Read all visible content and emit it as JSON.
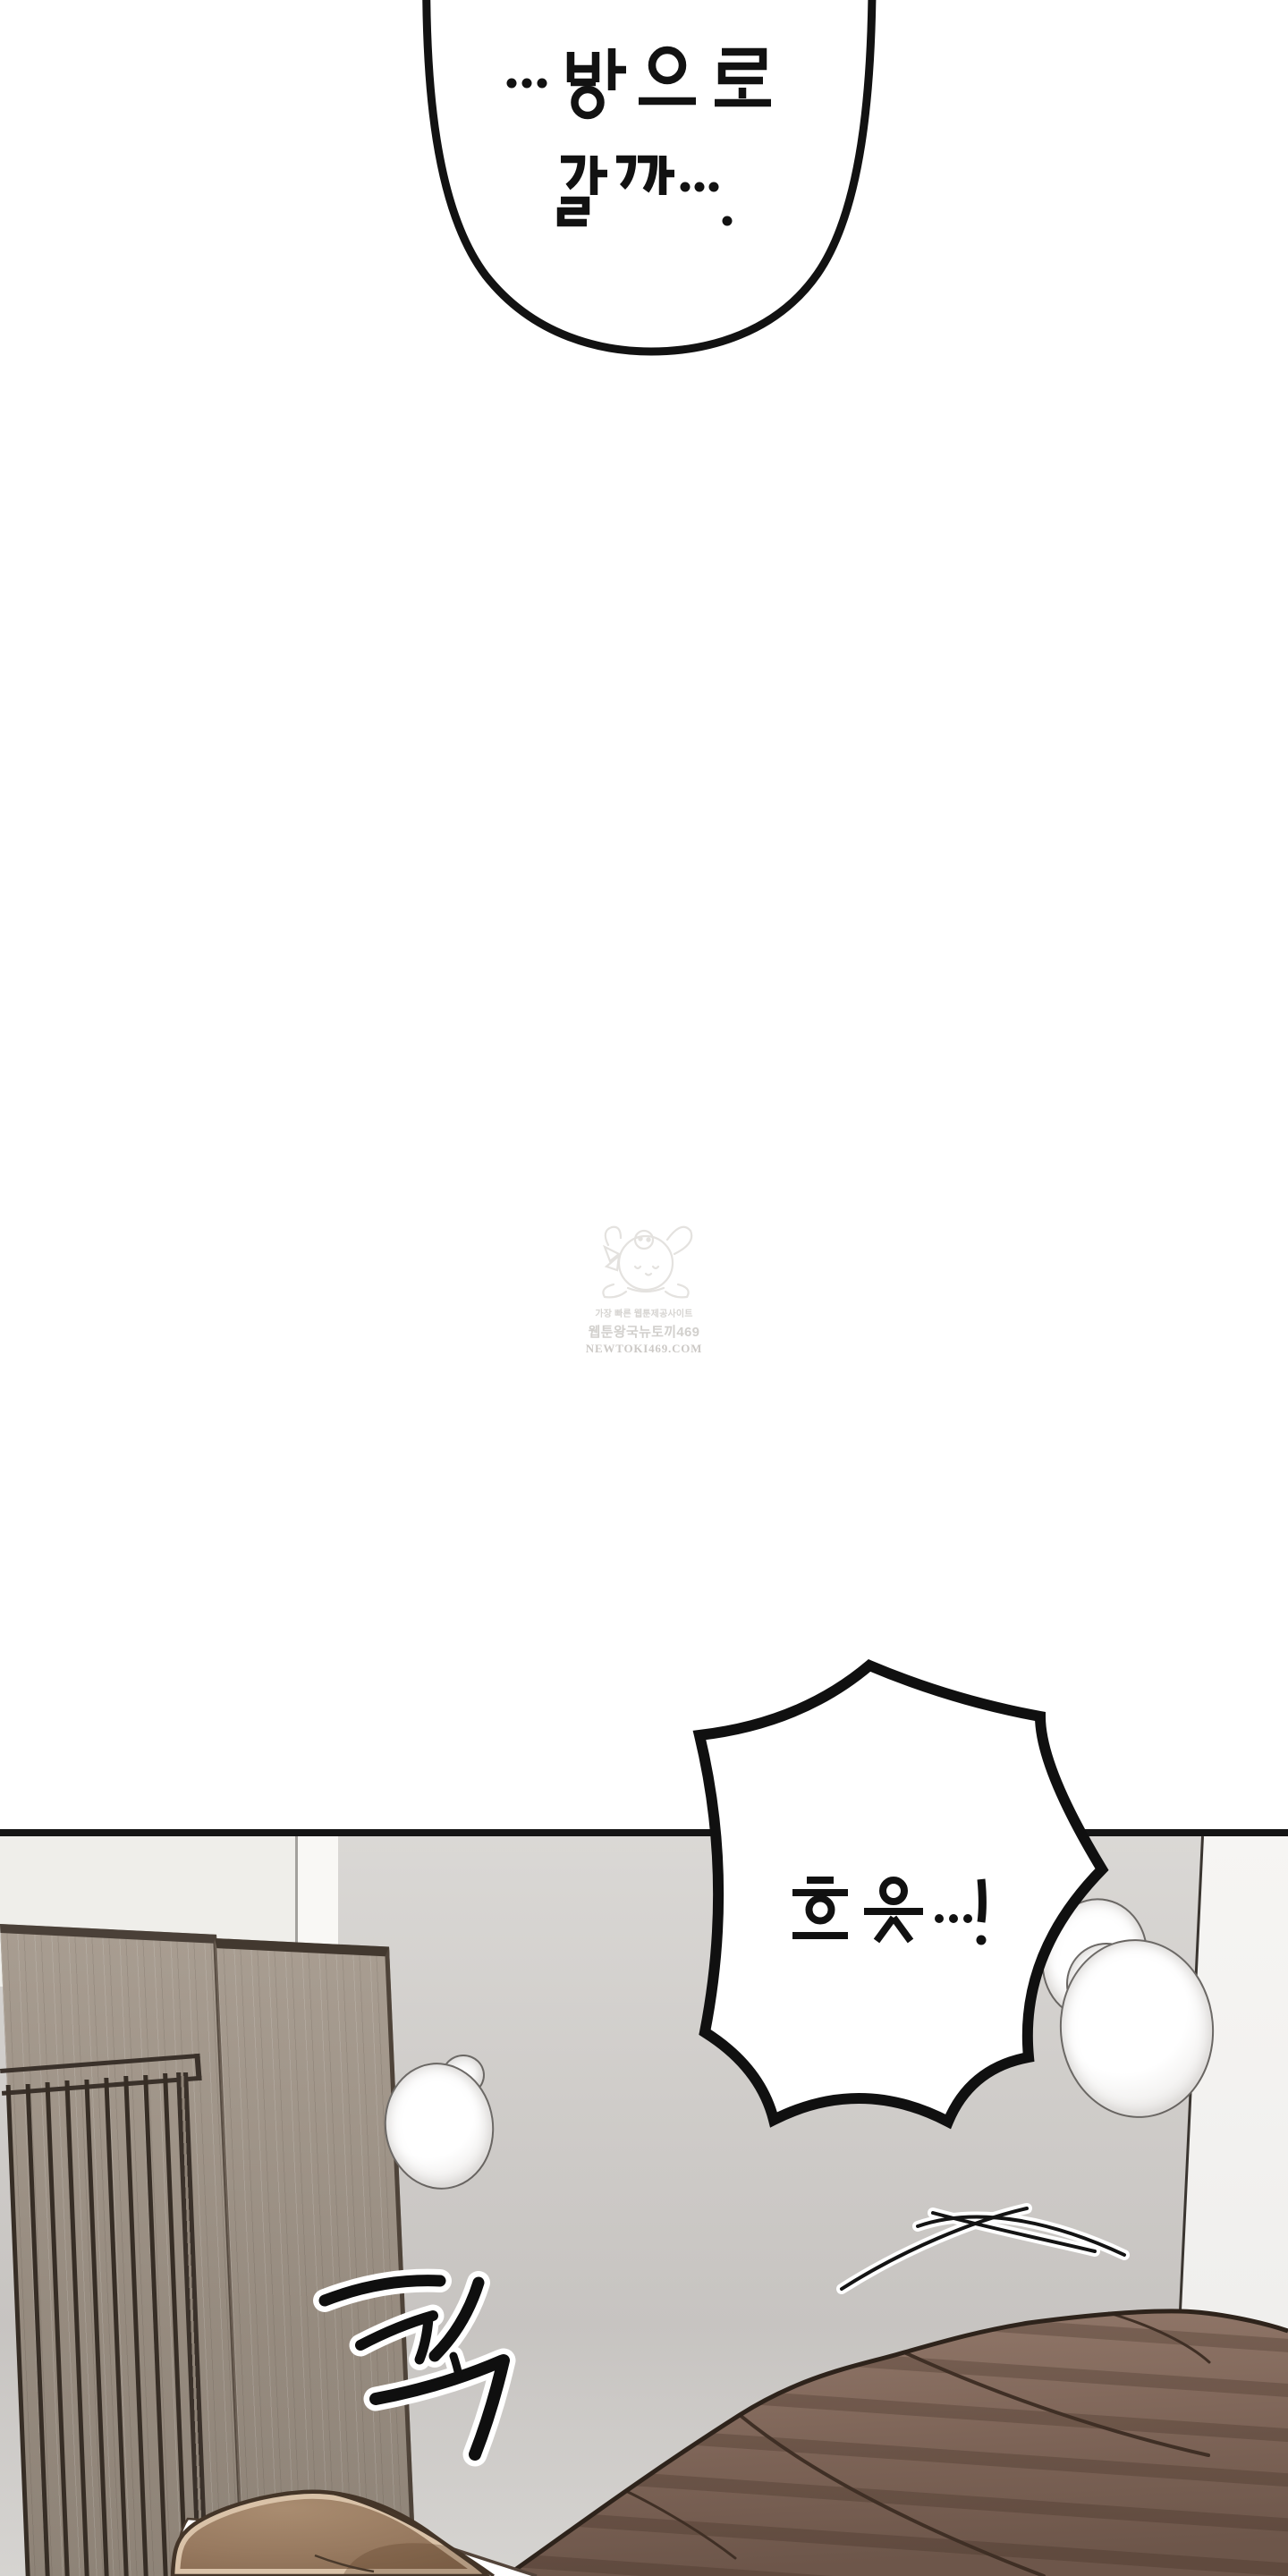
{
  "bubbles": {
    "top": {
      "line1": "…방으로",
      "line2": "갈까…."
    },
    "burst": {
      "text": "흐읏…!"
    }
  },
  "sfx": {
    "impact": "콱"
  },
  "watermark": {
    "line1": "가장 빠른 웹툰제공사이트",
    "line2": "웹툰왕국뉴토끼469",
    "line3": "NEWTOKI469.COM"
  },
  "colors": {
    "background": "#ffffff",
    "panel_border": "#151515",
    "wall_main": "#cecbc8",
    "wall_left": "#efeeea",
    "wall_corner_strip": "#f9f8f5",
    "wall_right": "#f4f3f1",
    "wood": "#9b9084",
    "wood_trim": "#463c33",
    "slat": "#362d25",
    "blanket": "#7e6557",
    "blanket_fold": "#3f2f25",
    "hair": "#97795f",
    "hair_rim": "#d9c2a8",
    "line_art": "#111111"
  }
}
